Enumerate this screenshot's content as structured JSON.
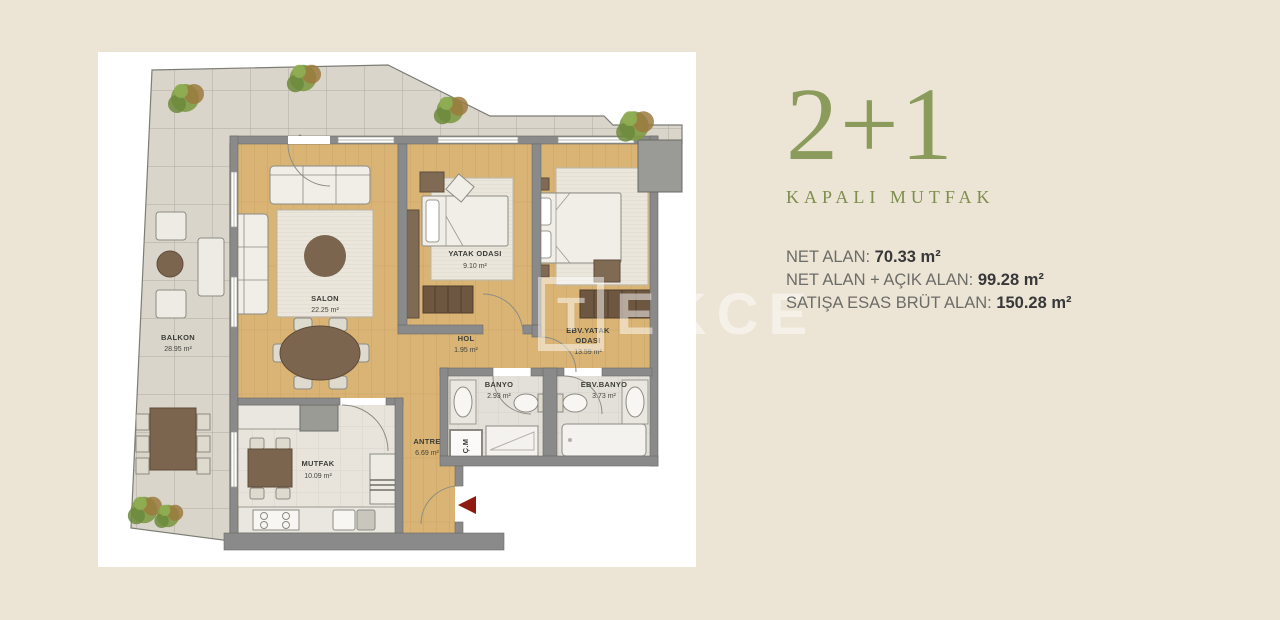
{
  "info_panel": {
    "title": "2+1",
    "subtitle": "KAPALI MUTFAK",
    "measurements": [
      {
        "label": "NET ALAN: ",
        "value": "70.33 m²"
      },
      {
        "label": "NET ALAN + AÇIK ALAN: ",
        "value": "99.28 m²"
      },
      {
        "label": "SATIŞA ESAS BRÜT ALAN: ",
        "value": "150.28 m²"
      }
    ]
  },
  "floor_plan": {
    "rooms": {
      "balkon": {
        "name": "BALKON",
        "area": "28.95 m²"
      },
      "salon": {
        "name": "SALON",
        "area": "22.25 m²"
      },
      "yatak": {
        "name": "YATAK ODASI",
        "area": "9.10 m²"
      },
      "ebv_yatak": {
        "name_line1": "EBV.YATAK",
        "name_line2": "ODASI",
        "area": "13.59 m²"
      },
      "hol": {
        "name": "HOL",
        "area": "1.95 m²"
      },
      "banyo": {
        "name": "BANYO",
        "area": "2.93 m²"
      },
      "ebv_banyo": {
        "name": "EBV.BANYO",
        "area": "3.73 m²"
      },
      "antre": {
        "name": "ANTRE",
        "area": "6.69 m²"
      },
      "mutfak": {
        "name": "MUTFAK",
        "area": "10.09 m²"
      }
    },
    "closet_label": "Ç.M",
    "watermark": {
      "logo_letter": "T",
      "text": "EKCE"
    }
  },
  "colors": {
    "page_background": "#ece4d4",
    "panel_background": "#ffffff",
    "accent_green": "#8a9b5c",
    "entrance_arrow_red": "#8e1a10",
    "wall_gray": "#8a8a8a",
    "wood_floor": "#d9b475",
    "terrace_tile": "#d9d5cb"
  }
}
